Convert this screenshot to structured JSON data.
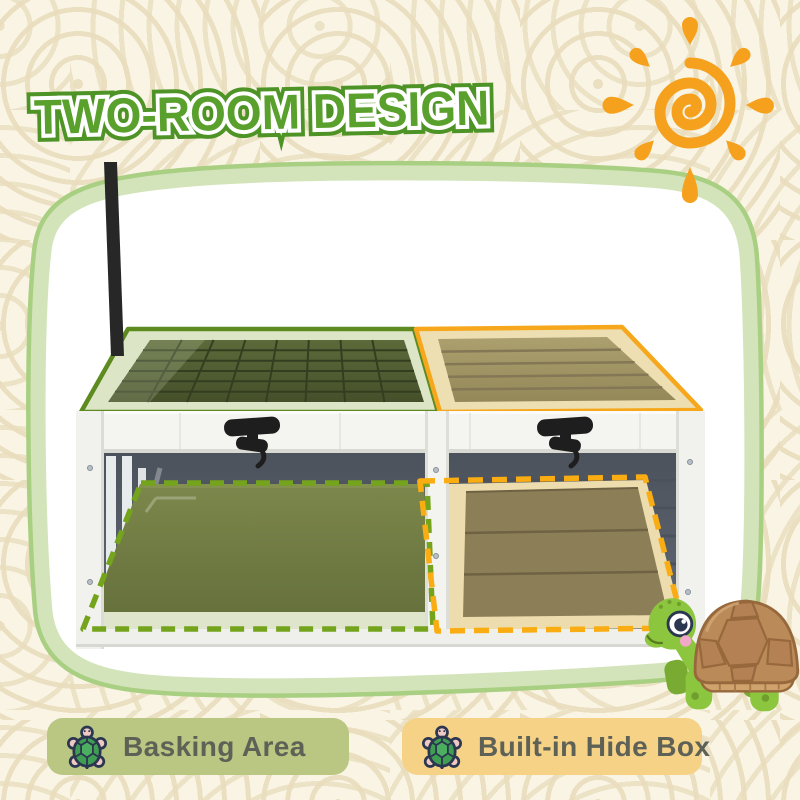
{
  "header": {
    "title": "TWO-ROOM DESIGN"
  },
  "decor": {
    "background_color": "#f9f4e4",
    "pattern_color": "#e9ddbd",
    "panel_border_color": "#a9cf82",
    "title_color": "#5aa02c",
    "sun_color": "#f6a11e"
  },
  "product": {
    "name": "two-room tortoise enclosure",
    "highlights": [
      {
        "id": "basking-room",
        "solid_outline": "#5d8b20",
        "dashed_outline": "#74a31c"
      },
      {
        "id": "hide-box-room",
        "solid_outline": "#f6a71b",
        "dashed_outline": "#f9ad12"
      }
    ]
  },
  "legend": [
    {
      "label": "Basking Area",
      "chip_color": "#b9c783",
      "icon": "turtle-icon"
    },
    {
      "label": "Built-in Hide Box",
      "chip_color": "#f6d287",
      "icon": "turtle-icon"
    }
  ],
  "mascot": {
    "icon": "turtle-mascot"
  }
}
